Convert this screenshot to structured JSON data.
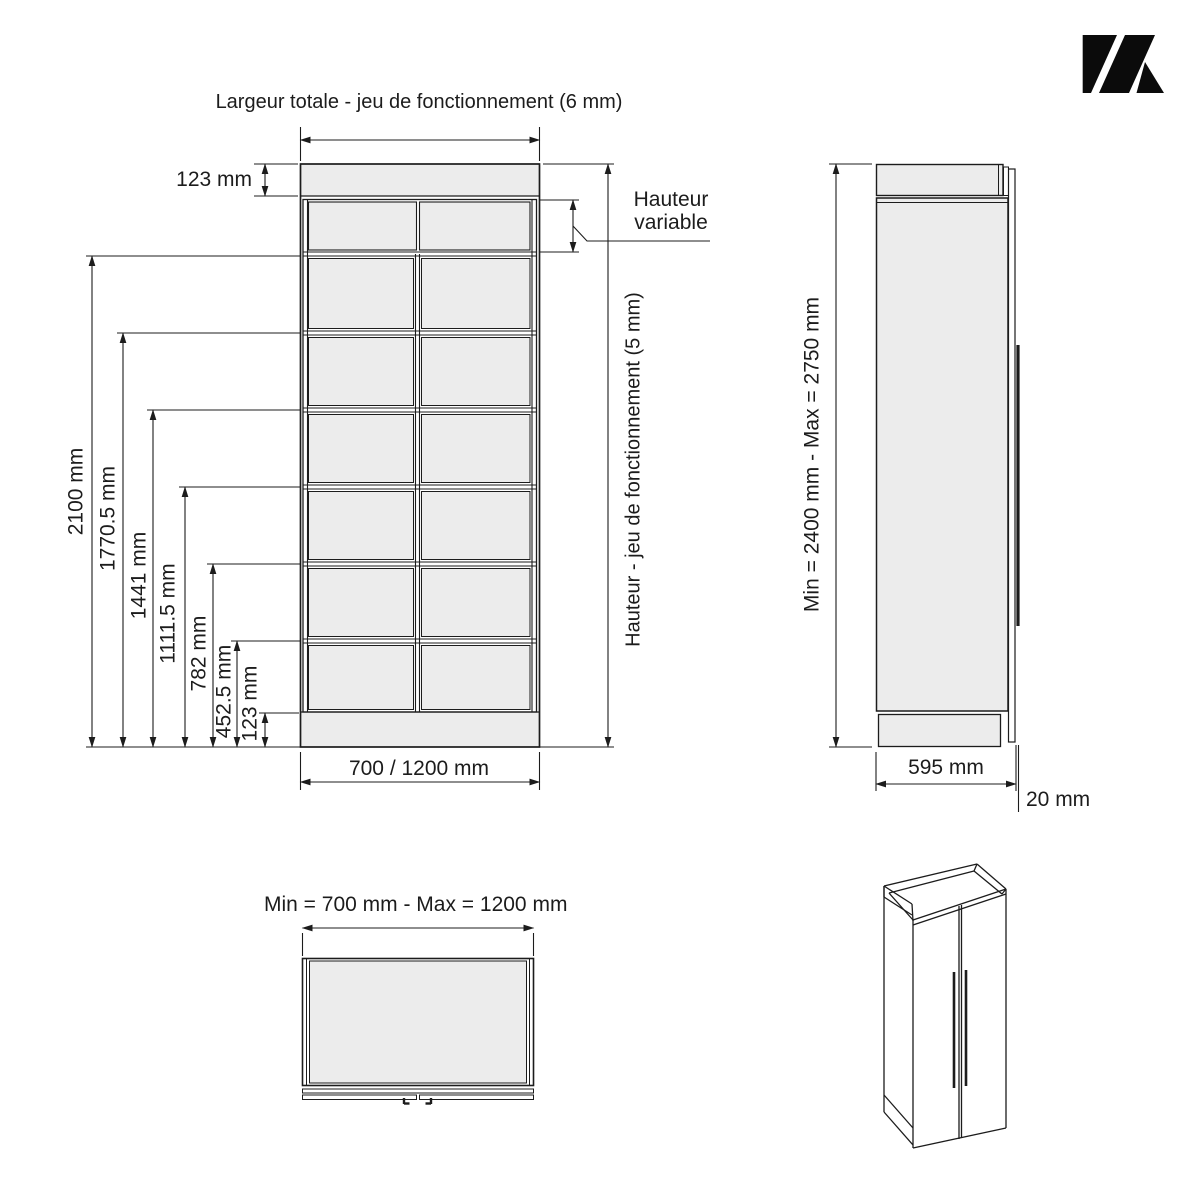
{
  "front_view": {
    "title": "Largeur totale - jeu de fonctionnement (6 mm)",
    "cornice_dim": "123 mm",
    "height_dims": [
      "2100 mm",
      "1770.5 mm",
      "1441 mm",
      "1111.5 mm",
      "782 mm",
      "452.5 mm",
      "123 mm"
    ],
    "variable_line1": "Hauteur",
    "variable_line2": "variable",
    "height_clearance_label": "Hauteur - jeu de fonctionnement (5 mm)",
    "width_dim": "700 / 1200 mm"
  },
  "side_view": {
    "height_range": "Min = 2400 mm - Max = 2750 mm",
    "depth_dim": "595 mm",
    "thickness_dim": "20 mm"
  },
  "top_view": {
    "width_range": "Min = 700 mm - Max = 1200 mm"
  },
  "colors": {
    "panel_fill": "#ececec",
    "line": "#1c1c1c",
    "logo": "#0b0b0b"
  }
}
